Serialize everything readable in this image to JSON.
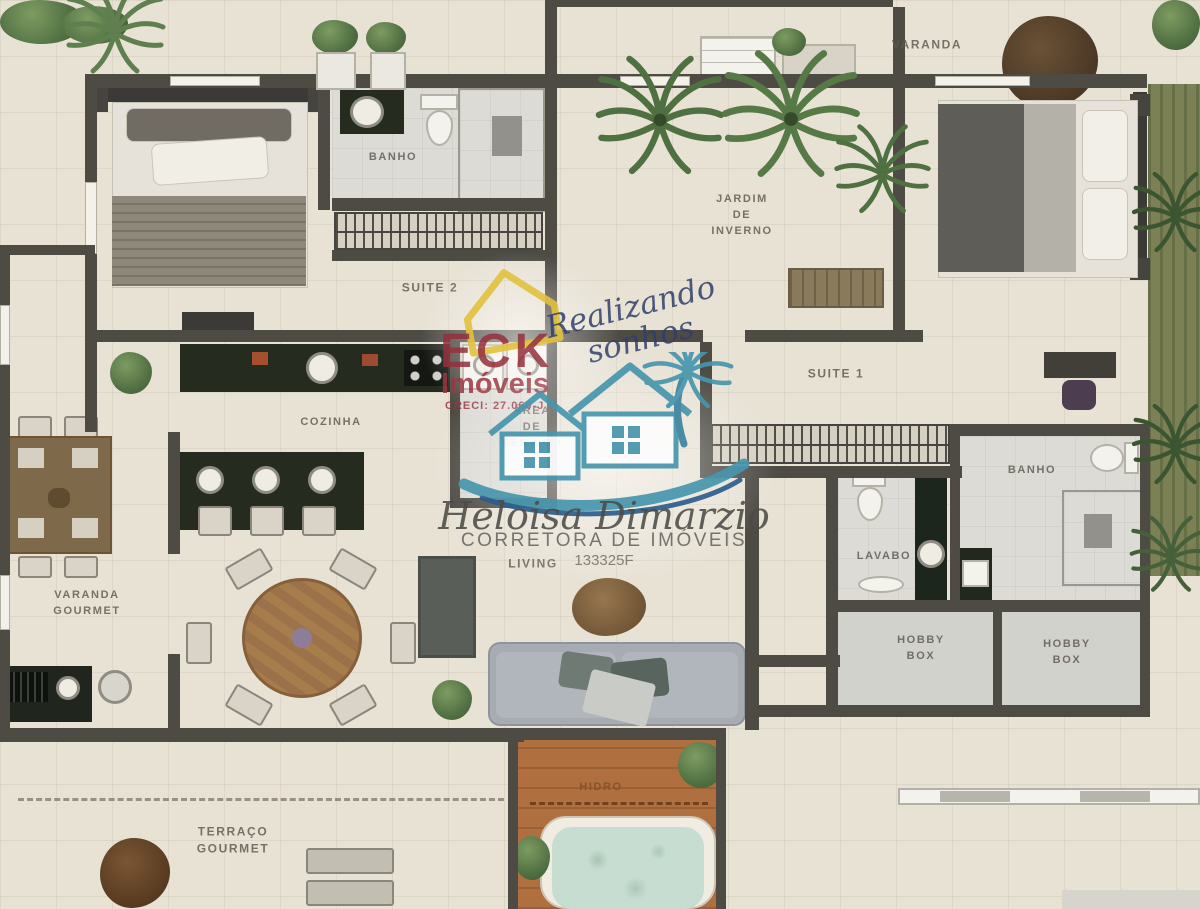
{
  "rooms": {
    "varanda": "VARANDA",
    "suite2": "SUITE 2",
    "banho_suite2": "BANHO",
    "jardim_inverno": [
      "JARDIM",
      "DE",
      "INVERNO"
    ],
    "suite1": "SUITE 1",
    "cozinha": "COZINHA",
    "area_servico": [
      "ÁREA",
      "DE",
      "SERVIÇO"
    ],
    "banho_suite1": "BANHO",
    "lavabo": "LAVABO",
    "hobby_box_left": [
      "HOBBY",
      "BOX"
    ],
    "hobby_box_right": [
      "HOBBY",
      "BOX"
    ],
    "varanda_gourmet": [
      "VARANDA",
      "GOURMET"
    ],
    "living": "LIVING",
    "terraco_gourmet": [
      "TERRAÇO",
      "GOURMET"
    ],
    "hidro": "HIDRO"
  },
  "watermarks": {
    "agency": {
      "name": "ECK",
      "type": "Imóveis",
      "creci": "CRECI: 27.060-J",
      "slogan": [
        "Realizando",
        "sonhos"
      ]
    },
    "broker": {
      "name": "Heloisa Dimarzio",
      "title": "CORRETORA DE IMÓVEIS",
      "license": "133325F"
    }
  },
  "icons": {
    "palm_plant": "svg-radiating-fronds",
    "bush_plant": "css-radial-green-blob",
    "logo_palm_tree": "svg-fronds-teal",
    "logo_house": "svg-house-outline-teal",
    "logo_house_yellow": "svg-house-outline-yellow",
    "logo_wave": "svg-swoosh"
  },
  "colors": {
    "wall": "#4e4b45",
    "floor": "#e8e2d5",
    "wet_floor": "#dcdbd5",
    "deck": "#b06f3e",
    "tub_water": "#c7ddd2",
    "cabinet": "#262b20",
    "wood": "#8a6a42",
    "greenery": "#537244",
    "brand_red": "#96303c",
    "brand_yellow": "#e2c23e",
    "brand_navy": "#2f3f6b",
    "brand_teal": "#4796ad"
  }
}
